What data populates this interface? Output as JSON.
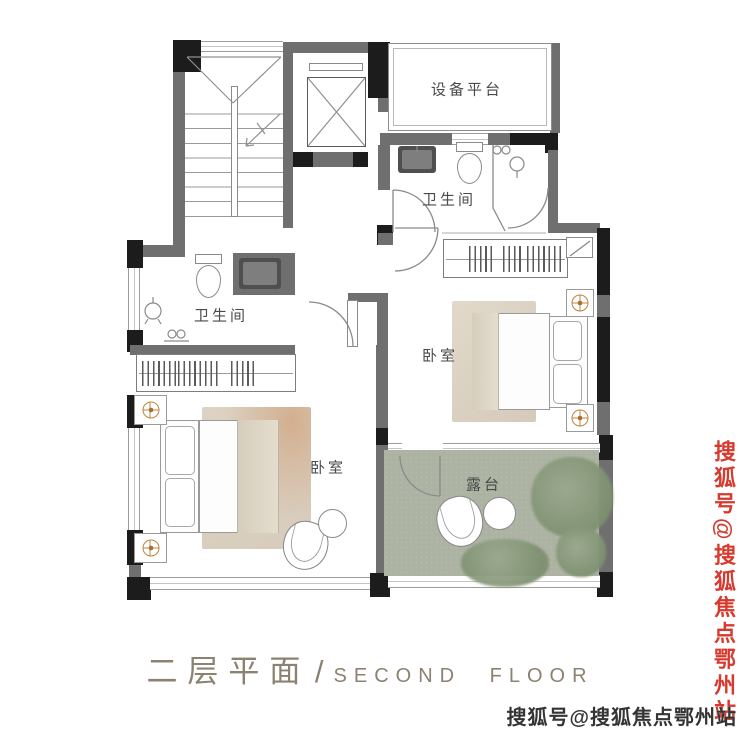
{
  "plan": {
    "rooms": {
      "equipment_platform": "设备平台",
      "bathroom_top": "卫生间",
      "bathroom_left": "卫生间",
      "bedroom_right": "卧室",
      "bedroom_left": "卧室",
      "terrace": "露台"
    }
  },
  "footer": {
    "title_zh": "二层平面",
    "separator": "/",
    "title_en": "SECOND FLOOR"
  },
  "watermarks": {
    "side_vertical": "搜狐号@搜狐焦点鄂州站",
    "bottom_right": "搜狐号@搜狐焦点鄂州站"
  },
  "colors": {
    "wall_gray": "#6f6f6f",
    "structure_black": "#1c1c1c",
    "accent_gold": "#bf8440",
    "terrace_green": "#adb3a3",
    "rug_tan": "#d9cec0",
    "title_tan": "#8c8272",
    "watermark_red": "#d63a2e",
    "watermark_dark": "#343434"
  },
  "icons": {
    "ceiling_light": "compass-circle-cross",
    "elevator_shaft": "crossed-box",
    "stair_direction": "diagonal-arrow",
    "wardrobe_hangers": "tick-row",
    "door_swing": "quarter-arc"
  }
}
